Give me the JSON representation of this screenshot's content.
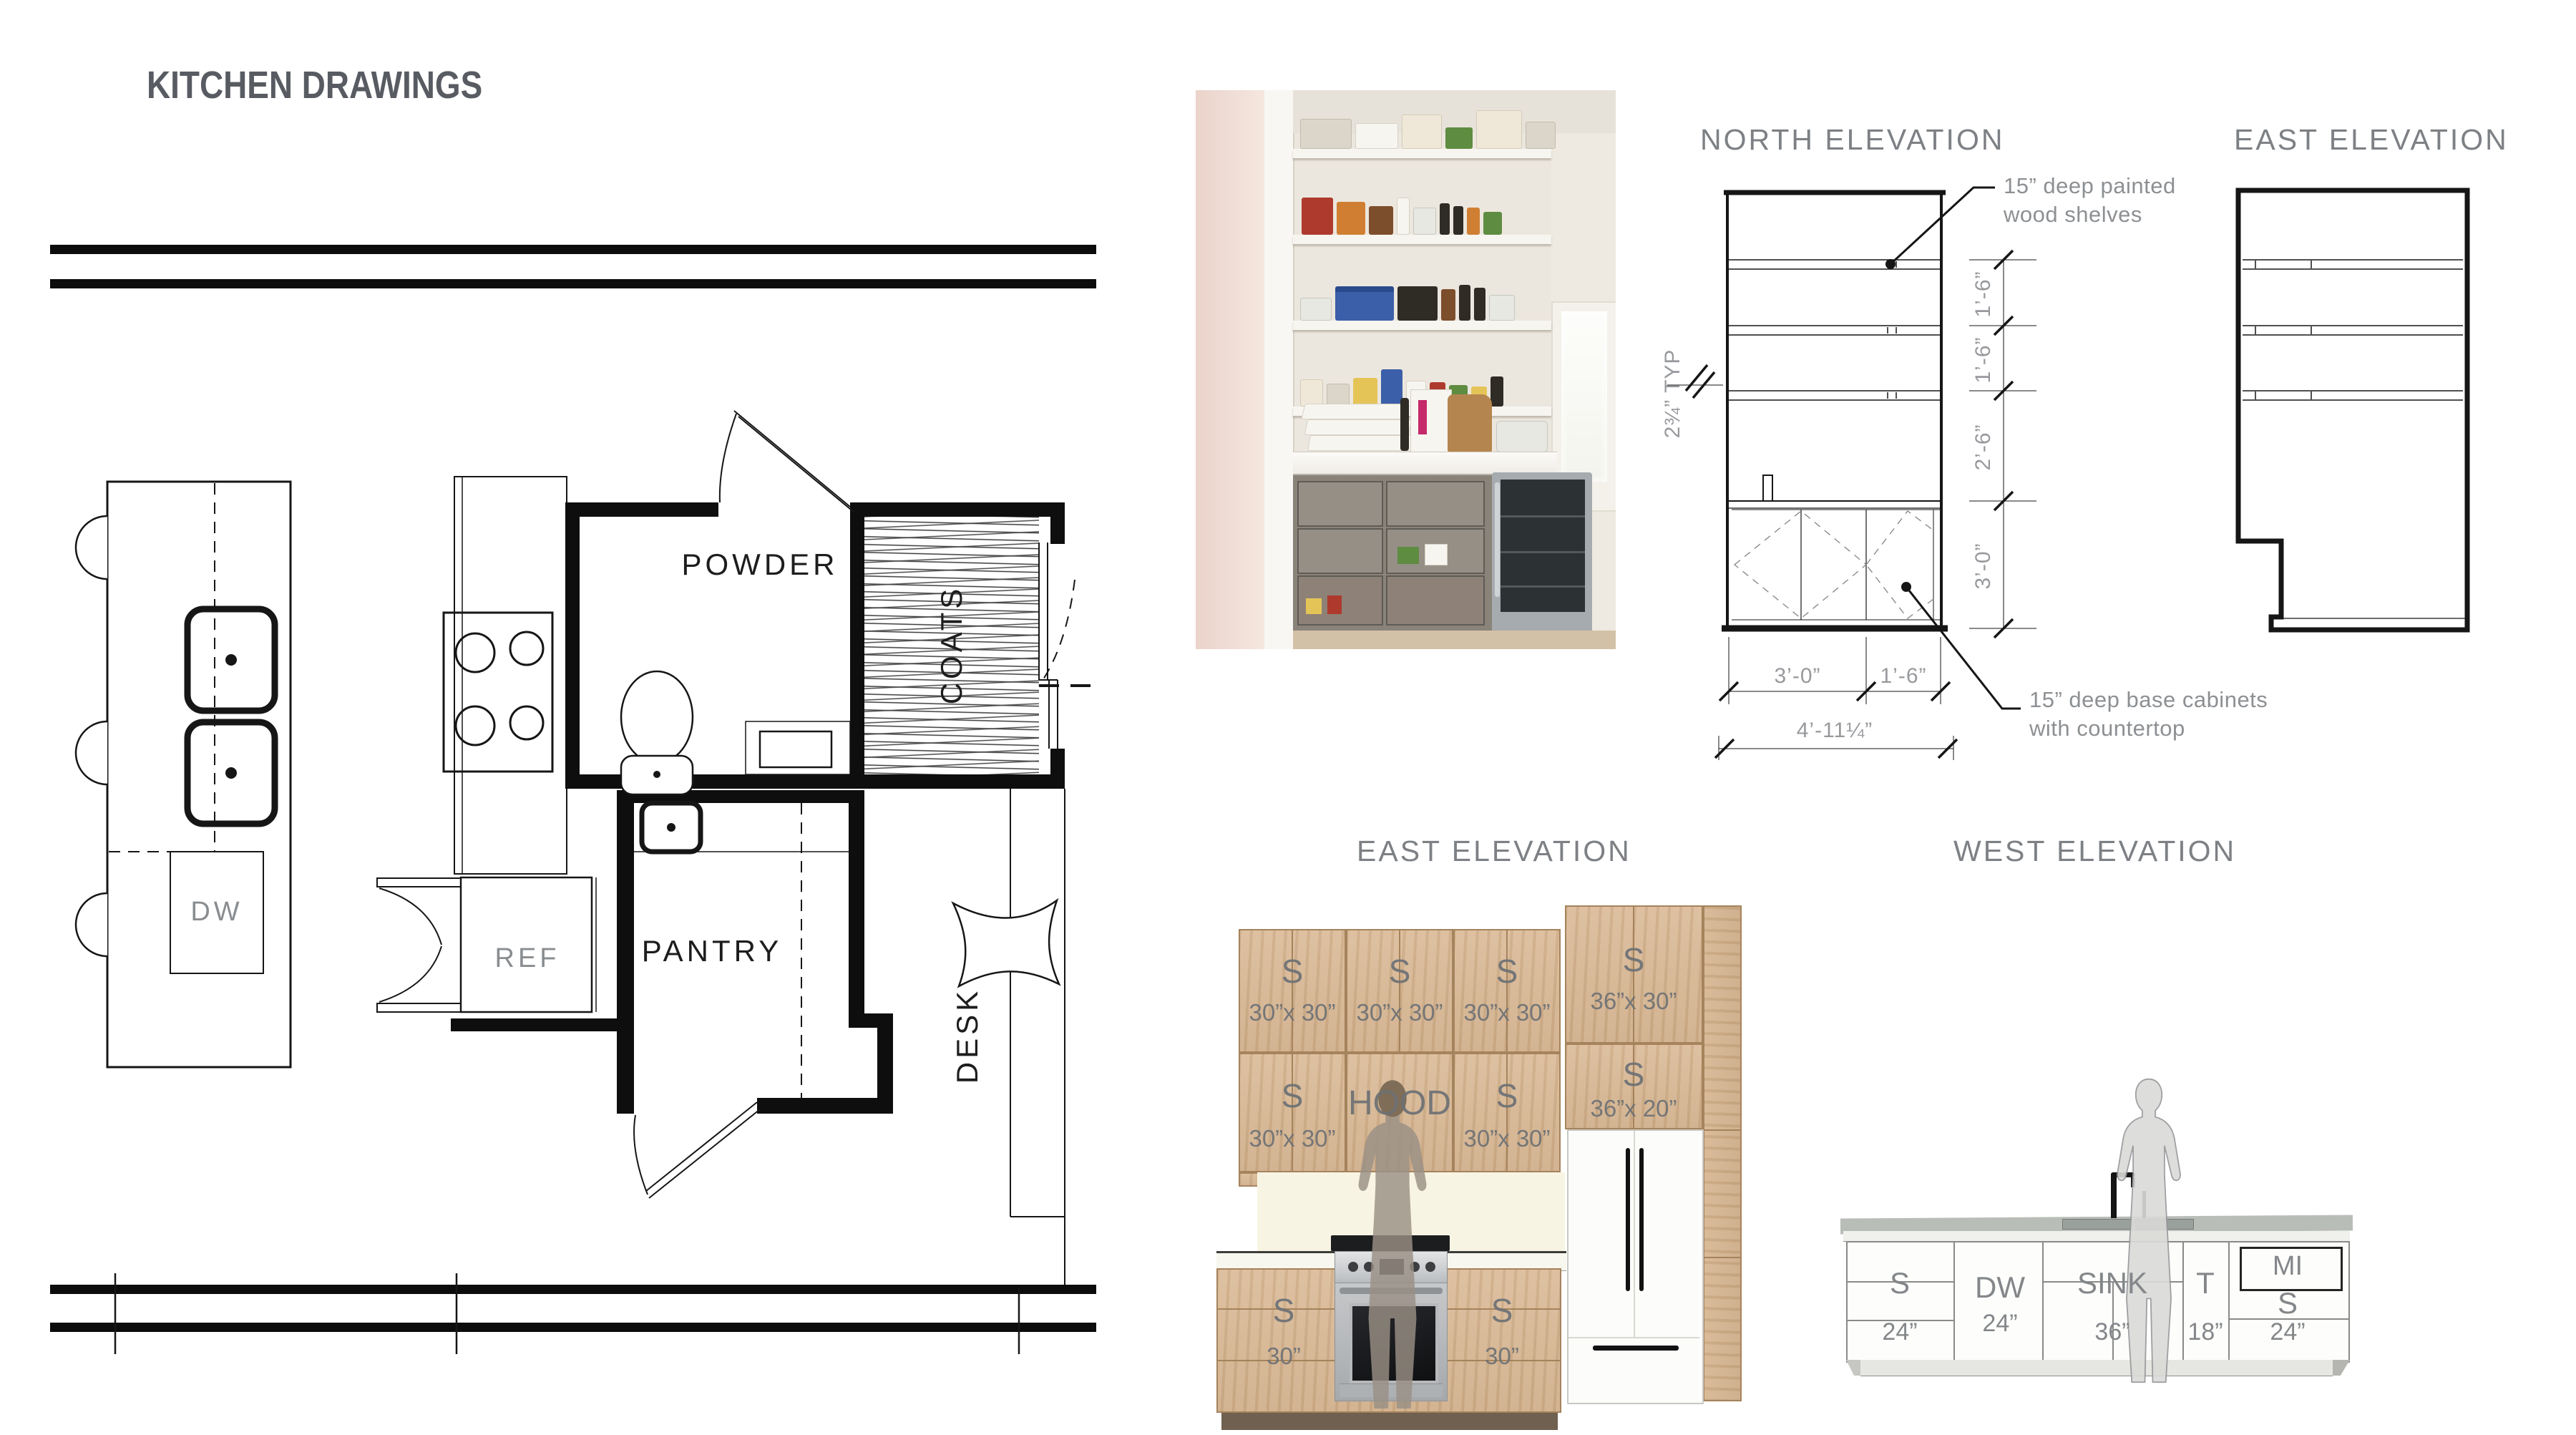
{
  "page": {
    "title": "KITCHEN DRAWINGS"
  },
  "palette": {
    "line": "#161616",
    "title_gray": "#7d8084",
    "label_gray": "#8a8d90",
    "dim_gray": "#97999c",
    "wood": "#d6b693",
    "backsplash": "#f8f4e3"
  },
  "plan": {
    "powder": "POWDER",
    "coats": "COATS",
    "pantry": "PANTRY",
    "desk": "DESK",
    "dw": "DW",
    "ref": "REF"
  },
  "north": {
    "title": "NORTH ELEVATION",
    "shelf_note": "15” deep painted wood shelves",
    "base_note": "15” deep base cabinets with countertop",
    "typ": "2¾” TYP",
    "d1": "1’-6”",
    "d2": "1’-6”",
    "d3": "2’-6”",
    "d4": "3’-0”",
    "b1": "3’-0”",
    "b2": "1’-6”",
    "total": "4’-11¼”"
  },
  "east_top": {
    "title": "EAST ELEVATION"
  },
  "east_rend": {
    "title": "EAST ELEVATION",
    "u1a_s": "S",
    "u1a_d": "30”x 30”",
    "u1b_s": "S",
    "u1b_d": "30”x 30”",
    "u1c_s": "S",
    "u1c_d": "30”x 30”",
    "u2a_s": "S",
    "u2a_d": "30”x 30”",
    "hood": "HOOD",
    "u2c_s": "S",
    "u2c_d": "30”x 30”",
    "t1_s": "S",
    "t1_d": "36”x 30”",
    "t2_s": "S",
    "t2_d": "36”x 20”",
    "b1_s": "S",
    "b1_d": "30”",
    "b2_s": "S",
    "b2_d": "30”"
  },
  "west": {
    "title": "WEST ELEVATION",
    "s1": "S",
    "s1_d": "24”",
    "dw": "DW",
    "dw_d": "24”",
    "sink": "SINK",
    "sink_d": "36”",
    "t": "T",
    "t_d": "18”",
    "mi": "MI",
    "s2": "S",
    "s2_d": "24”"
  }
}
